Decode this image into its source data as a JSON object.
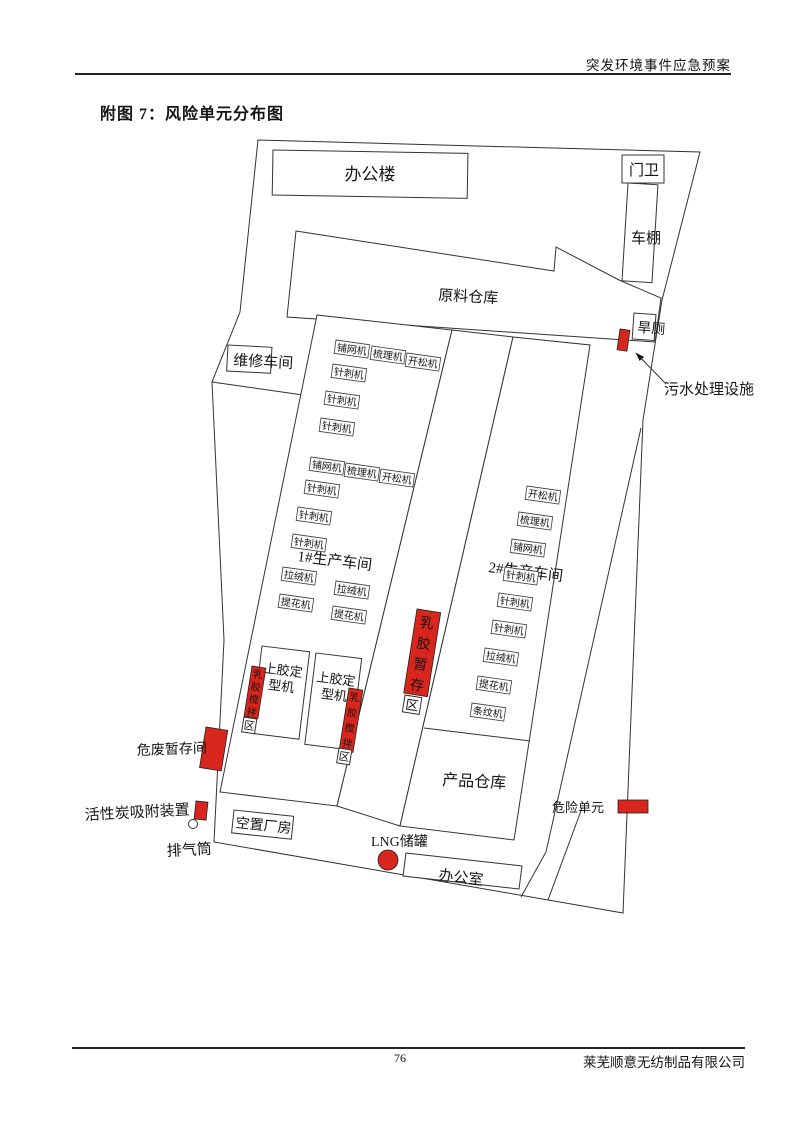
{
  "header": {
    "doc_title": "突发环境事件应急预案"
  },
  "figure_title": "附图 7：风险单元分布图",
  "footer": {
    "page_number": "76",
    "company": "莱芜顺意无纺制品有限公司"
  },
  "colors": {
    "risk_red": "#d9261c",
    "line": "#333333"
  },
  "site_plan": {
    "buildings": {
      "office_building": "办公楼",
      "gate_house": "门卫",
      "carport": "车棚",
      "raw_material_warehouse": "原料仓库",
      "dry_toilet": "旱厕",
      "maintenance_workshop": "维修车间",
      "workshop_1": "1#生产车间",
      "workshop_2": "2#生产车间",
      "product_warehouse": "产品仓库",
      "vacant_building": "空置厂房",
      "office_room": "办公室",
      "glue_setting_machine_line1": "上胶定",
      "glue_setting_machine_line2": "型机"
    },
    "risk_labels": {
      "sewage_treatment": "污水处理设施",
      "hazardous_waste_storage": "危废暂存间",
      "activated_carbon_device": "活性炭吸附装置",
      "exhaust_stack": "排气筒",
      "lng_tank": "LNG储罐",
      "legend_hazard_unit": "危险单元",
      "latex_storage_vertical": "乳胶暂存",
      "latex_storage_suffix": "区",
      "latex_mixing_vertical": "乳胶搅拌",
      "latex_mixing_suffix": "区"
    },
    "machine_labels": [
      {
        "text": "铺网机",
        "x": 336,
        "y": 340
      },
      {
        "text": "梳理机",
        "x": 372,
        "y": 346
      },
      {
        "text": "开松机",
        "x": 407,
        "y": 353
      },
      {
        "text": "针刺机",
        "x": 333,
        "y": 364
      },
      {
        "text": "针刺机",
        "x": 326,
        "y": 391
      },
      {
        "text": "针刺机",
        "x": 321,
        "y": 418
      },
      {
        "text": "铺网机",
        "x": 311,
        "y": 457
      },
      {
        "text": "梳理机",
        "x": 346,
        "y": 463
      },
      {
        "text": "开松机",
        "x": 381,
        "y": 469
      },
      {
        "text": "针刺机",
        "x": 306,
        "y": 480
      },
      {
        "text": "针刺机",
        "x": 298,
        "y": 507
      },
      {
        "text": "针刺机",
        "x": 293,
        "y": 534
      },
      {
        "text": "拉绒机",
        "x": 283,
        "y": 567
      },
      {
        "text": "拉绒机",
        "x": 336,
        "y": 581
      },
      {
        "text": "提花机",
        "x": 280,
        "y": 594
      },
      {
        "text": "提花机",
        "x": 333,
        "y": 606
      },
      {
        "text": "开松机",
        "x": 527,
        "y": 486
      },
      {
        "text": "梳理机",
        "x": 519,
        "y": 512
      },
      {
        "text": "铺网机",
        "x": 512,
        "y": 539
      },
      {
        "text": "针刺机",
        "x": 505,
        "y": 567
      },
      {
        "text": "针刺机",
        "x": 499,
        "y": 593
      },
      {
        "text": "针刺机",
        "x": 493,
        "y": 620
      },
      {
        "text": "拉绒机",
        "x": 485,
        "y": 648
      },
      {
        "text": "提花机",
        "x": 478,
        "y": 676
      },
      {
        "text": "条纹机",
        "x": 472,
        "y": 703
      }
    ]
  }
}
